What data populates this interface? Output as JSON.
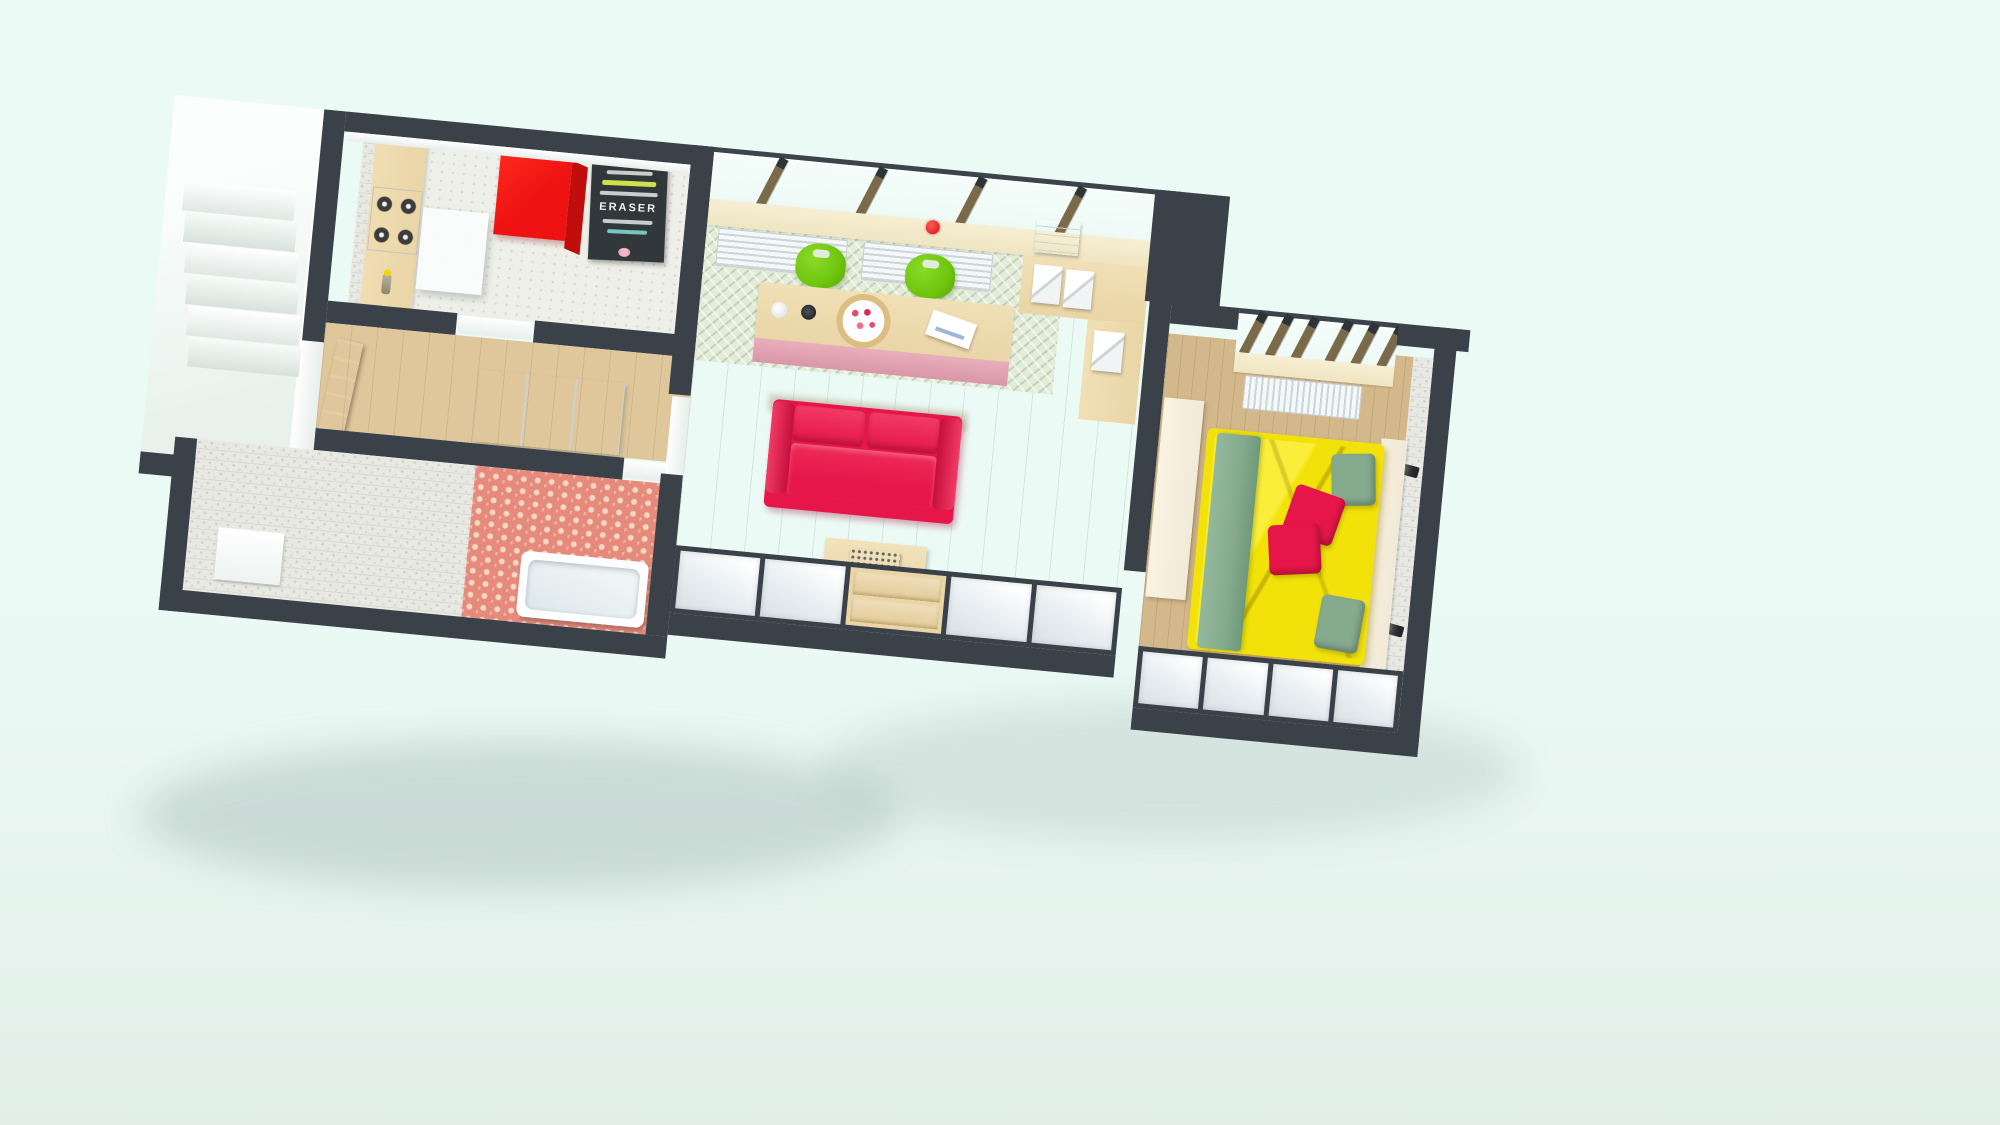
{
  "scene_title": "3D rendered one-bedroom apartment floor plan, bird's-eye view",
  "poster": {
    "word": "ERASER"
  },
  "colors": {
    "bg1": "#ecfaf6",
    "bg2": "#e2efe9",
    "wall": "#3a4149",
    "wallFace": "#f6faf9",
    "kitchenFloor": "#efefe9",
    "wood": "#e9d5a6",
    "woodDark": "#d9bf8a",
    "fridge": "#ee1212",
    "fridgeSide": "#c20d0d",
    "chalk": "#31383b",
    "glass": "#eefaf6",
    "sill": "#efe5c2",
    "mullion": "#7a6a49",
    "mullionCap": "#2e3338",
    "radiator": "#f5f8f8",
    "radiatorLine": "#ccd5d8",
    "chevron": "#e3ecd9",
    "chairGreen": "#6ec60c",
    "tablePink": "#e9aebc",
    "sofa": "#e6164a",
    "sofaDark": "#c50f3c",
    "floorTan": "#cfb187",
    "floorGray": "#b7aeaa",
    "cubbyA": "#ffffff",
    "cubbyB": "#d9e2e6",
    "tv": "#2c3237",
    "bedYellow": "#f2e20a",
    "bedYellowHi": "#fbee3a",
    "sage": "#85aa8e",
    "pillowRed": "#e6164a",
    "brick": "#eae8e0",
    "coral": "#e68b7c",
    "coralDot": "#f6d6c4",
    "stone": "#e9e9e4",
    "door": "#75572f",
    "cream": "#f2ead8",
    "hood": "#fbfdfd"
  },
  "rooms": [
    {
      "name": "stairwell",
      "furniture": [
        "staircase-steps",
        "landing"
      ]
    },
    {
      "name": "kitchen",
      "furniture": [
        "red-refrigerator",
        "kitchen-counter",
        "gas-stove",
        "extractor-hood",
        "chalkboard-poster",
        "oil-bottle"
      ]
    },
    {
      "name": "hallway",
      "furniture": [
        "front-door",
        "white-closet"
      ]
    },
    {
      "name": "bathroom",
      "furniture": [
        "bathtub",
        "bath-mat",
        "stone-tile-wall",
        "coral-accent-wall"
      ]
    },
    {
      "name": "living-room",
      "furniture": [
        "window-band",
        "radiator",
        "radiator",
        "dining-bar-table",
        "green-chair",
        "green-chair",
        "coffee-cup",
        "mug",
        "berry-plate",
        "envelope",
        "corner-desk",
        "paper-trays",
        "retro-radio",
        "red-sofa",
        "coffee-table",
        "typewriter",
        "flower-pot",
        "open-shelving",
        "drawer-unit",
        "tv-panel"
      ]
    },
    {
      "name": "bedroom",
      "furniture": [
        "window-band",
        "radiator",
        "double-bed-yellow-duvet",
        "sage-runner",
        "sage-pillows",
        "red-pillows",
        "wardrobe",
        "headboard-shelf",
        "wall-sconce",
        "wall-sconce",
        "open-shelving",
        "white-brick-wall"
      ]
    }
  ]
}
